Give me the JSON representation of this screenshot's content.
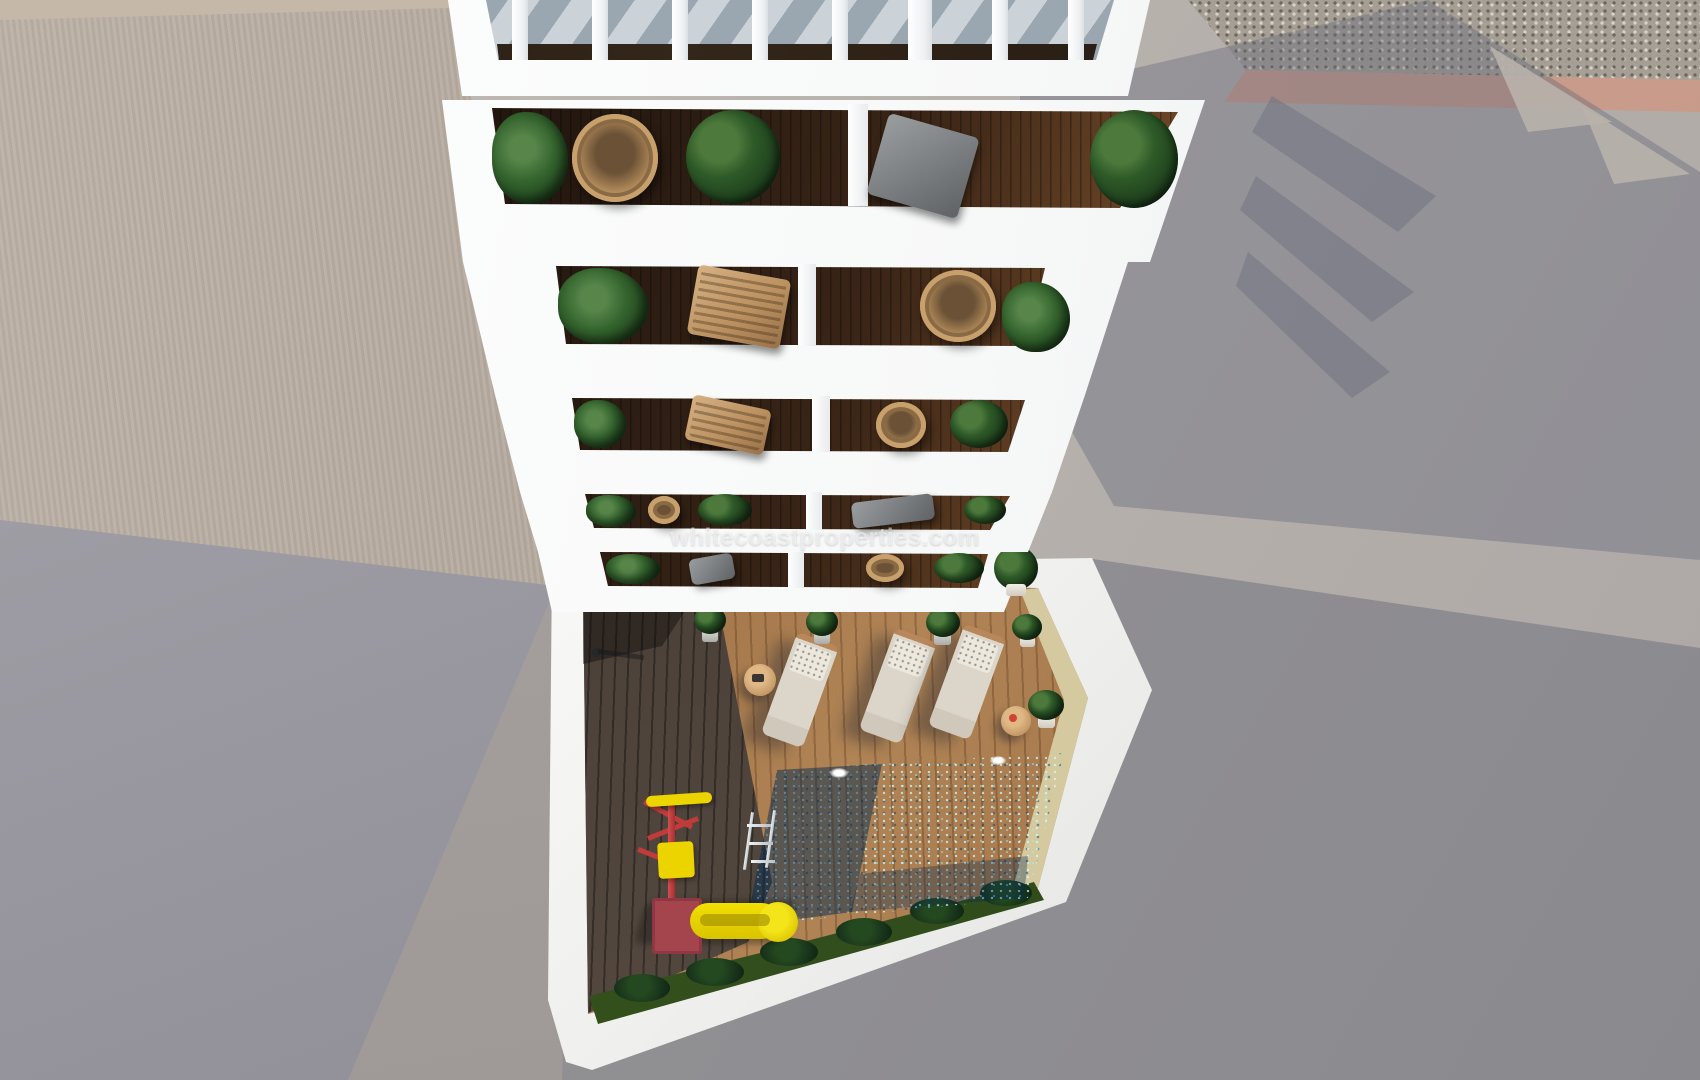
{
  "watermark": {
    "text": "whitecoastproperties.com"
  },
  "scene": {
    "type": "3d-aerial-architectural-render",
    "description": "Top-down view of a white apartment building with a slatted pergola roof, five rows of balconies with plants and chairs, and an inner courtyard with wooden decks, a sparkling blue swimming pool, three sun loungers, potted plants, a children's slide and a garden strip. Surrounding ground is grey concrete with long building shadows, gravel and a salmon kerb at top right.",
    "building": {
      "floors_visible": 5,
      "units_per_floor": 2,
      "roof_feature": "white slatted pergola",
      "balcony_items": [
        "potted plants",
        "rattan hanging chairs",
        "grey deck chairs",
        "tan lounge chairs",
        "dark wood flooring"
      ]
    },
    "courtyard": {
      "pool": {
        "lights": 2,
        "ladder": true
      },
      "sun_loungers": 3,
      "side_tables": 2,
      "potted_plants": 5,
      "playground": [
        "yellow slide",
        "red climbing frame"
      ],
      "garden": [
        "grass strip",
        "dark shrubs"
      ]
    }
  },
  "palette": {
    "building_white": "#ffffff",
    "ground_lit": "#bab4ae",
    "ground_shadow": "#8f9099",
    "roof_taupe": "#b2a79c",
    "gravel": "#a69f95",
    "salmon_kerb": "#cfa08c",
    "pool_light": "#2ab7d4",
    "pool_dark": "#0b5a89",
    "deck_light_wood": "#b08455",
    "deck_dark_wood": "#4c423a",
    "sand_wall": "#d8cda4",
    "grass": "#2c4719",
    "slide_yellow": "#ecd400",
    "frame_red": "#c23b3b",
    "foliage_green": "#2e5a28",
    "rattan_tan": "#caa472"
  }
}
